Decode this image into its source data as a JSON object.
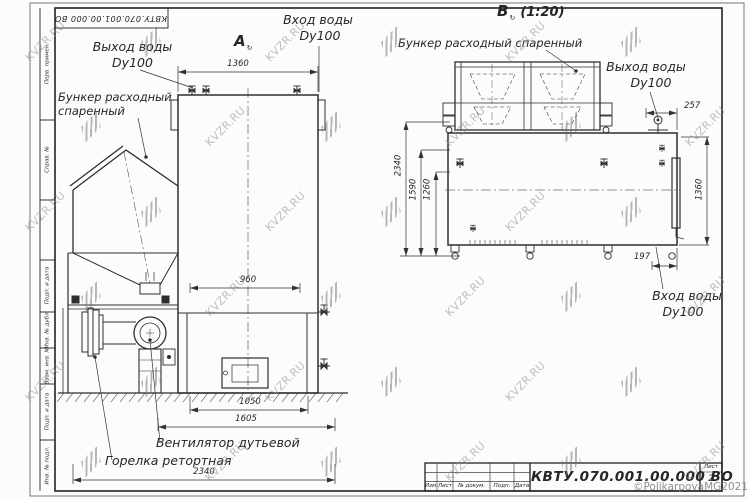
{
  "watermark": {
    "text": "KVZR.RU"
  },
  "frame": {
    "top_stamp": "КВТУ.070.001.00.000  ВО",
    "left_labels": [
      "Перв. примен.",
      "Справ. №",
      "Подп. и дата",
      "Инв. № дубл.",
      "Взам. инв. №",
      "Подп. и дата",
      "Инв. № подл."
    ]
  },
  "views": {
    "front": {
      "label": "A",
      "rotated_mark": "↻",
      "callouts": {
        "water_outlet": [
          "Выход воды",
          "Dy100"
        ],
        "hopper": [
          "Бункер расходный",
          "спаренный"
        ],
        "water_inlet": [
          "Вход воды",
          "Dy100"
        ],
        "fan": "Вентилятор дутьевой",
        "burner": "Горелка ретортная"
      },
      "dims": {
        "top_width": "1360",
        "furnace_width": "960",
        "lower_span": "1050",
        "base_span": "1605",
        "total_width": "2340"
      }
    },
    "side": {
      "label": "B",
      "rotated_mark": "↻",
      "scale": "(1:20)",
      "callouts": {
        "hopper": "Бункер расходный спаренный",
        "water_outlet": [
          "Выход воды",
          "Dy100"
        ],
        "water_inlet": [
          "Вход воды",
          "Dy100"
        ]
      },
      "dims": {
        "total_height": "2340",
        "mid_height": "1590",
        "inner_height": "1260",
        "top_offset": "257",
        "side_height": "1360",
        "bottom_offset": "197"
      }
    }
  },
  "title_block": {
    "designation": "КВТУ.070.001.00.000  ВО",
    "columns": [
      "Изм.",
      "Лист",
      "№ докум.",
      "Подп.",
      "Дата"
    ],
    "sheet_label": "Лист",
    "sheet_number": "2",
    "copyright": "©PolikarpovaMG2021"
  }
}
